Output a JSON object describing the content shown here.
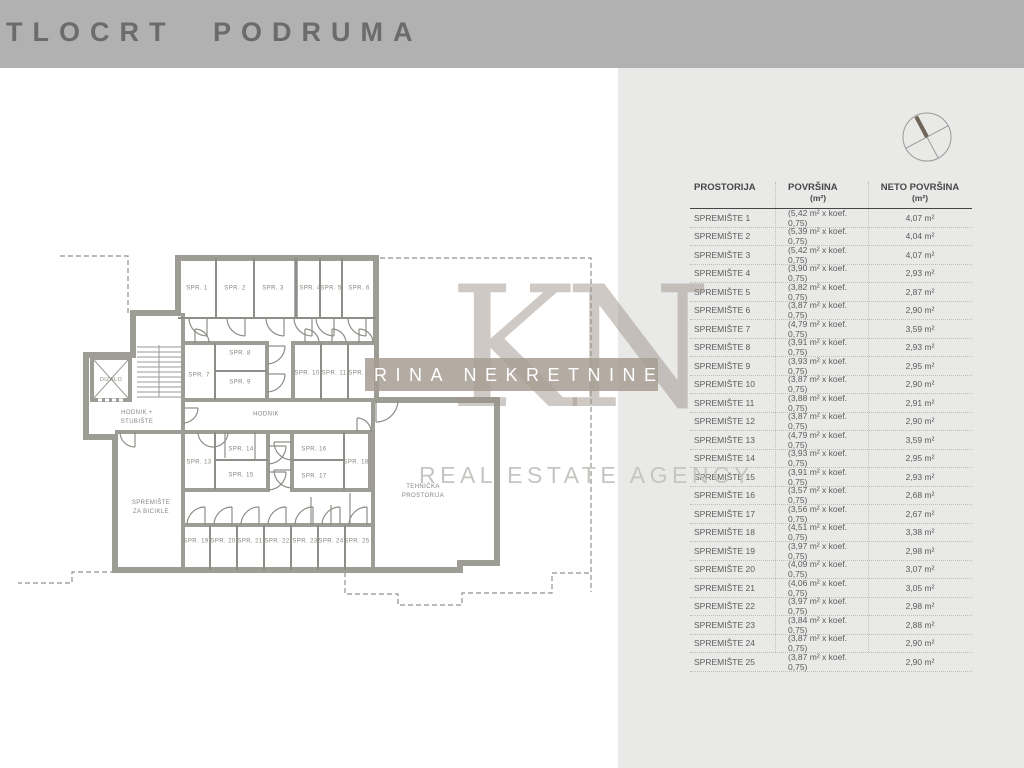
{
  "header": {
    "title": "TLOCRT PODRUMA"
  },
  "watermark": {
    "monogram": "KN",
    "band_text": "RINA NEKRETNINE",
    "subtitle": "REAL ESTATE AGENCY"
  },
  "colors": {
    "header_bg": "#b1b1b1",
    "panel_bg": "#e9e9e8",
    "wall": "#9d9d95",
    "watermark_band": "#a79d93"
  },
  "floor_plan": {
    "rooms": [
      "SPR. 1",
      "SPR. 2",
      "SPR. 3",
      "SPR. 4",
      "SPR. 5",
      "SPR. 6",
      "SPR. 7",
      "SPR. 8",
      "SPR. 9",
      "SPR. 10",
      "SPR. 11",
      "SPR. 12",
      "SPR. 13",
      "SPR. 14",
      "SPR. 15",
      "SPR. 16",
      "SPR. 17",
      "SPR. 18",
      "SPR. 19",
      "SPR. 20",
      "SPR. 21",
      "SPR. 22",
      "SPR. 23",
      "SPR. 24",
      "SPR. 25"
    ],
    "labels": {
      "elevator": "DIZALO",
      "corridor": "HODNIK",
      "corridor_stairs_1": "HODNIK +",
      "corridor_stairs_2": "STUBIŠTE",
      "bike_1": "SPREMIŠTE",
      "bike_2": "ZA BICIKLE",
      "tech_1": "TEHNIČKA",
      "tech_2": "PROSTORIJA"
    }
  },
  "table": {
    "col1": {
      "label": "PROSTORIJA"
    },
    "col2": {
      "label": "POVRŠINA",
      "sub": "(m²)"
    },
    "col3": {
      "label": "NETO POVRŠINA",
      "sub": "(m²)"
    },
    "rows": [
      [
        "SPREMIŠTE 1",
        "(5,42 m² x koef. 0,75)",
        "4,07 m²"
      ],
      [
        "SPREMIŠTE 2",
        "(5,39 m² x koef. 0,75)",
        "4,04 m²"
      ],
      [
        "SPREMIŠTE 3",
        "(5,42 m² x koef. 0,75)",
        "4,07 m²"
      ],
      [
        "SPREMIŠTE 4",
        "(3,90 m² x koef. 0,75)",
        "2,93 m²"
      ],
      [
        "SPREMIŠTE 5",
        "(3,82 m² x koef. 0,75)",
        "2,87 m²"
      ],
      [
        "SPREMIŠTE 6",
        "(3,87 m² x koef. 0,75)",
        "2,90 m²"
      ],
      [
        "SPREMIŠTE 7",
        "(4,79 m² x koef. 0,75)",
        "3,59 m²"
      ],
      [
        "SPREMIŠTE 8",
        "(3,91 m² x koef. 0,75)",
        "2,93 m²"
      ],
      [
        "SPREMIŠTE 9",
        "(3,93 m² x koef. 0,75)",
        "2,95 m²"
      ],
      [
        "SPREMIŠTE 10",
        "(3,87 m² x koef. 0,75)",
        "2,90 m²"
      ],
      [
        "SPREMIŠTE 11",
        "(3,88 m² x koef. 0,75)",
        "2,91 m²"
      ],
      [
        "SPREMIŠTE 12",
        "(3,87 m² x koef. 0,75)",
        "2,90 m²"
      ],
      [
        "SPREMIŠTE 13",
        "(4,79 m² x koef. 0,75)",
        "3,59 m²"
      ],
      [
        "SPREMIŠTE 14",
        "(3,93 m² x koef. 0,75)",
        "2,95 m²"
      ],
      [
        "SPREMIŠTE 15",
        "(3,91 m² x koef. 0,75)",
        "2,93 m²"
      ],
      [
        "SPREMIŠTE 16",
        "(3,57 m² x koef. 0,75)",
        "2,68 m²"
      ],
      [
        "SPREMIŠTE 17",
        "(3,56 m² x koef. 0,75)",
        "2,67 m²"
      ],
      [
        "SPREMIŠTE 18",
        "(4,51 m² x koef. 0,75)",
        "3,38 m²"
      ],
      [
        "SPREMIŠTE 19",
        "(3,97 m² x koef. 0,75)",
        "2,98 m²"
      ],
      [
        "SPREMIŠTE 20",
        "(4,09 m² x koef. 0,75)",
        "3,07 m²"
      ],
      [
        "SPREMIŠTE 21",
        "(4,06 m² x koef. 0,75)",
        "3,05 m²"
      ],
      [
        "SPREMIŠTE 22",
        "(3,97 m² x koef. 0,75)",
        "2,98 m²"
      ],
      [
        "SPREMIŠTE 23",
        "(3,84 m² x koef. 0,75)",
        "2,88 m²"
      ],
      [
        "SPREMIŠTE 24",
        "(3,87 m² x koef. 0,75)",
        "2,90 m²"
      ],
      [
        "SPREMIŠTE 25",
        "(3,87 m² x koef. 0,75)",
        "2,90 m²"
      ]
    ]
  }
}
